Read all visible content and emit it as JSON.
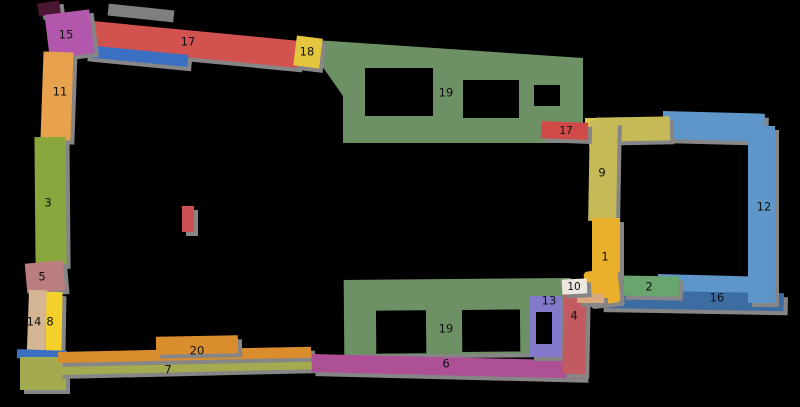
{
  "background": "#000000",
  "shadow_color": "#868686",
  "label_color": "#101010",
  "segments": {
    "s1": {
      "label": "1",
      "color": "#eab02b"
    },
    "s1blob": {
      "label": "",
      "color": "#eab02b"
    },
    "s2": {
      "label": "2",
      "color": "#69a56e"
    },
    "s3": {
      "label": "3",
      "color": "#8aa73e"
    },
    "s4": {
      "label": "4",
      "color": "#c15a61"
    },
    "s5": {
      "label": "5",
      "color": "#bb7e80"
    },
    "s6": {
      "label": "6",
      "color": "#ad5096"
    },
    "s7": {
      "label": "7",
      "color": "#a3aa4f"
    },
    "s8": {
      "label": "8",
      "color": "#f4d02a"
    },
    "s9": {
      "label": "9",
      "color": "#c6ba58"
    },
    "s9top": {
      "label": "",
      "color": "#c6ba58"
    },
    "s10": {
      "label": "10",
      "color": "#ece7e1"
    },
    "s10tan": {
      "label": "",
      "color": "#daa97e"
    },
    "s11": {
      "label": "11",
      "color": "#e8a24d"
    },
    "s12": {
      "label": "12",
      "color": "#5f96c9"
    },
    "s12top": {
      "label": "",
      "color": "#5f96c9"
    },
    "s13": {
      "label": "13",
      "color": "#8279ca"
    },
    "s14": {
      "label": "14",
      "color": "#d4b692"
    },
    "s15": {
      "label": "15",
      "color": "#b357ad"
    },
    "s15cap": {
      "label": "",
      "color": "#4a1631"
    },
    "s16": {
      "label": "16",
      "color": "#3d6ca3"
    },
    "s16light": {
      "label": "",
      "color": "#5f96c9"
    },
    "s17a": {
      "label": "17",
      "color": "#d25250"
    },
    "s17ablue": {
      "label": "",
      "color": "#3b6fc2"
    },
    "s17b": {
      "label": "17",
      "color": "#d04b48"
    },
    "s18": {
      "label": "18",
      "color": "#e5c53d"
    },
    "s19a": {
      "label": "19",
      "color": "#6d9165"
    },
    "s19b": {
      "label": "19",
      "color": "#6d9165"
    },
    "s20": {
      "label": "20",
      "color": "#d98d2d"
    },
    "sycorner": {
      "label": "",
      "color": "#dcc44e"
    },
    "sbluesw": {
      "label": "",
      "color": "#3b6fc2"
    },
    "solivesw": {
      "label": "",
      "color": "#a3aa4f"
    },
    "sgraytop": {
      "label": "",
      "color": "#7f7f7f"
    },
    "smarker": {
      "label": "",
      "color": "#cc4f52"
    }
  }
}
